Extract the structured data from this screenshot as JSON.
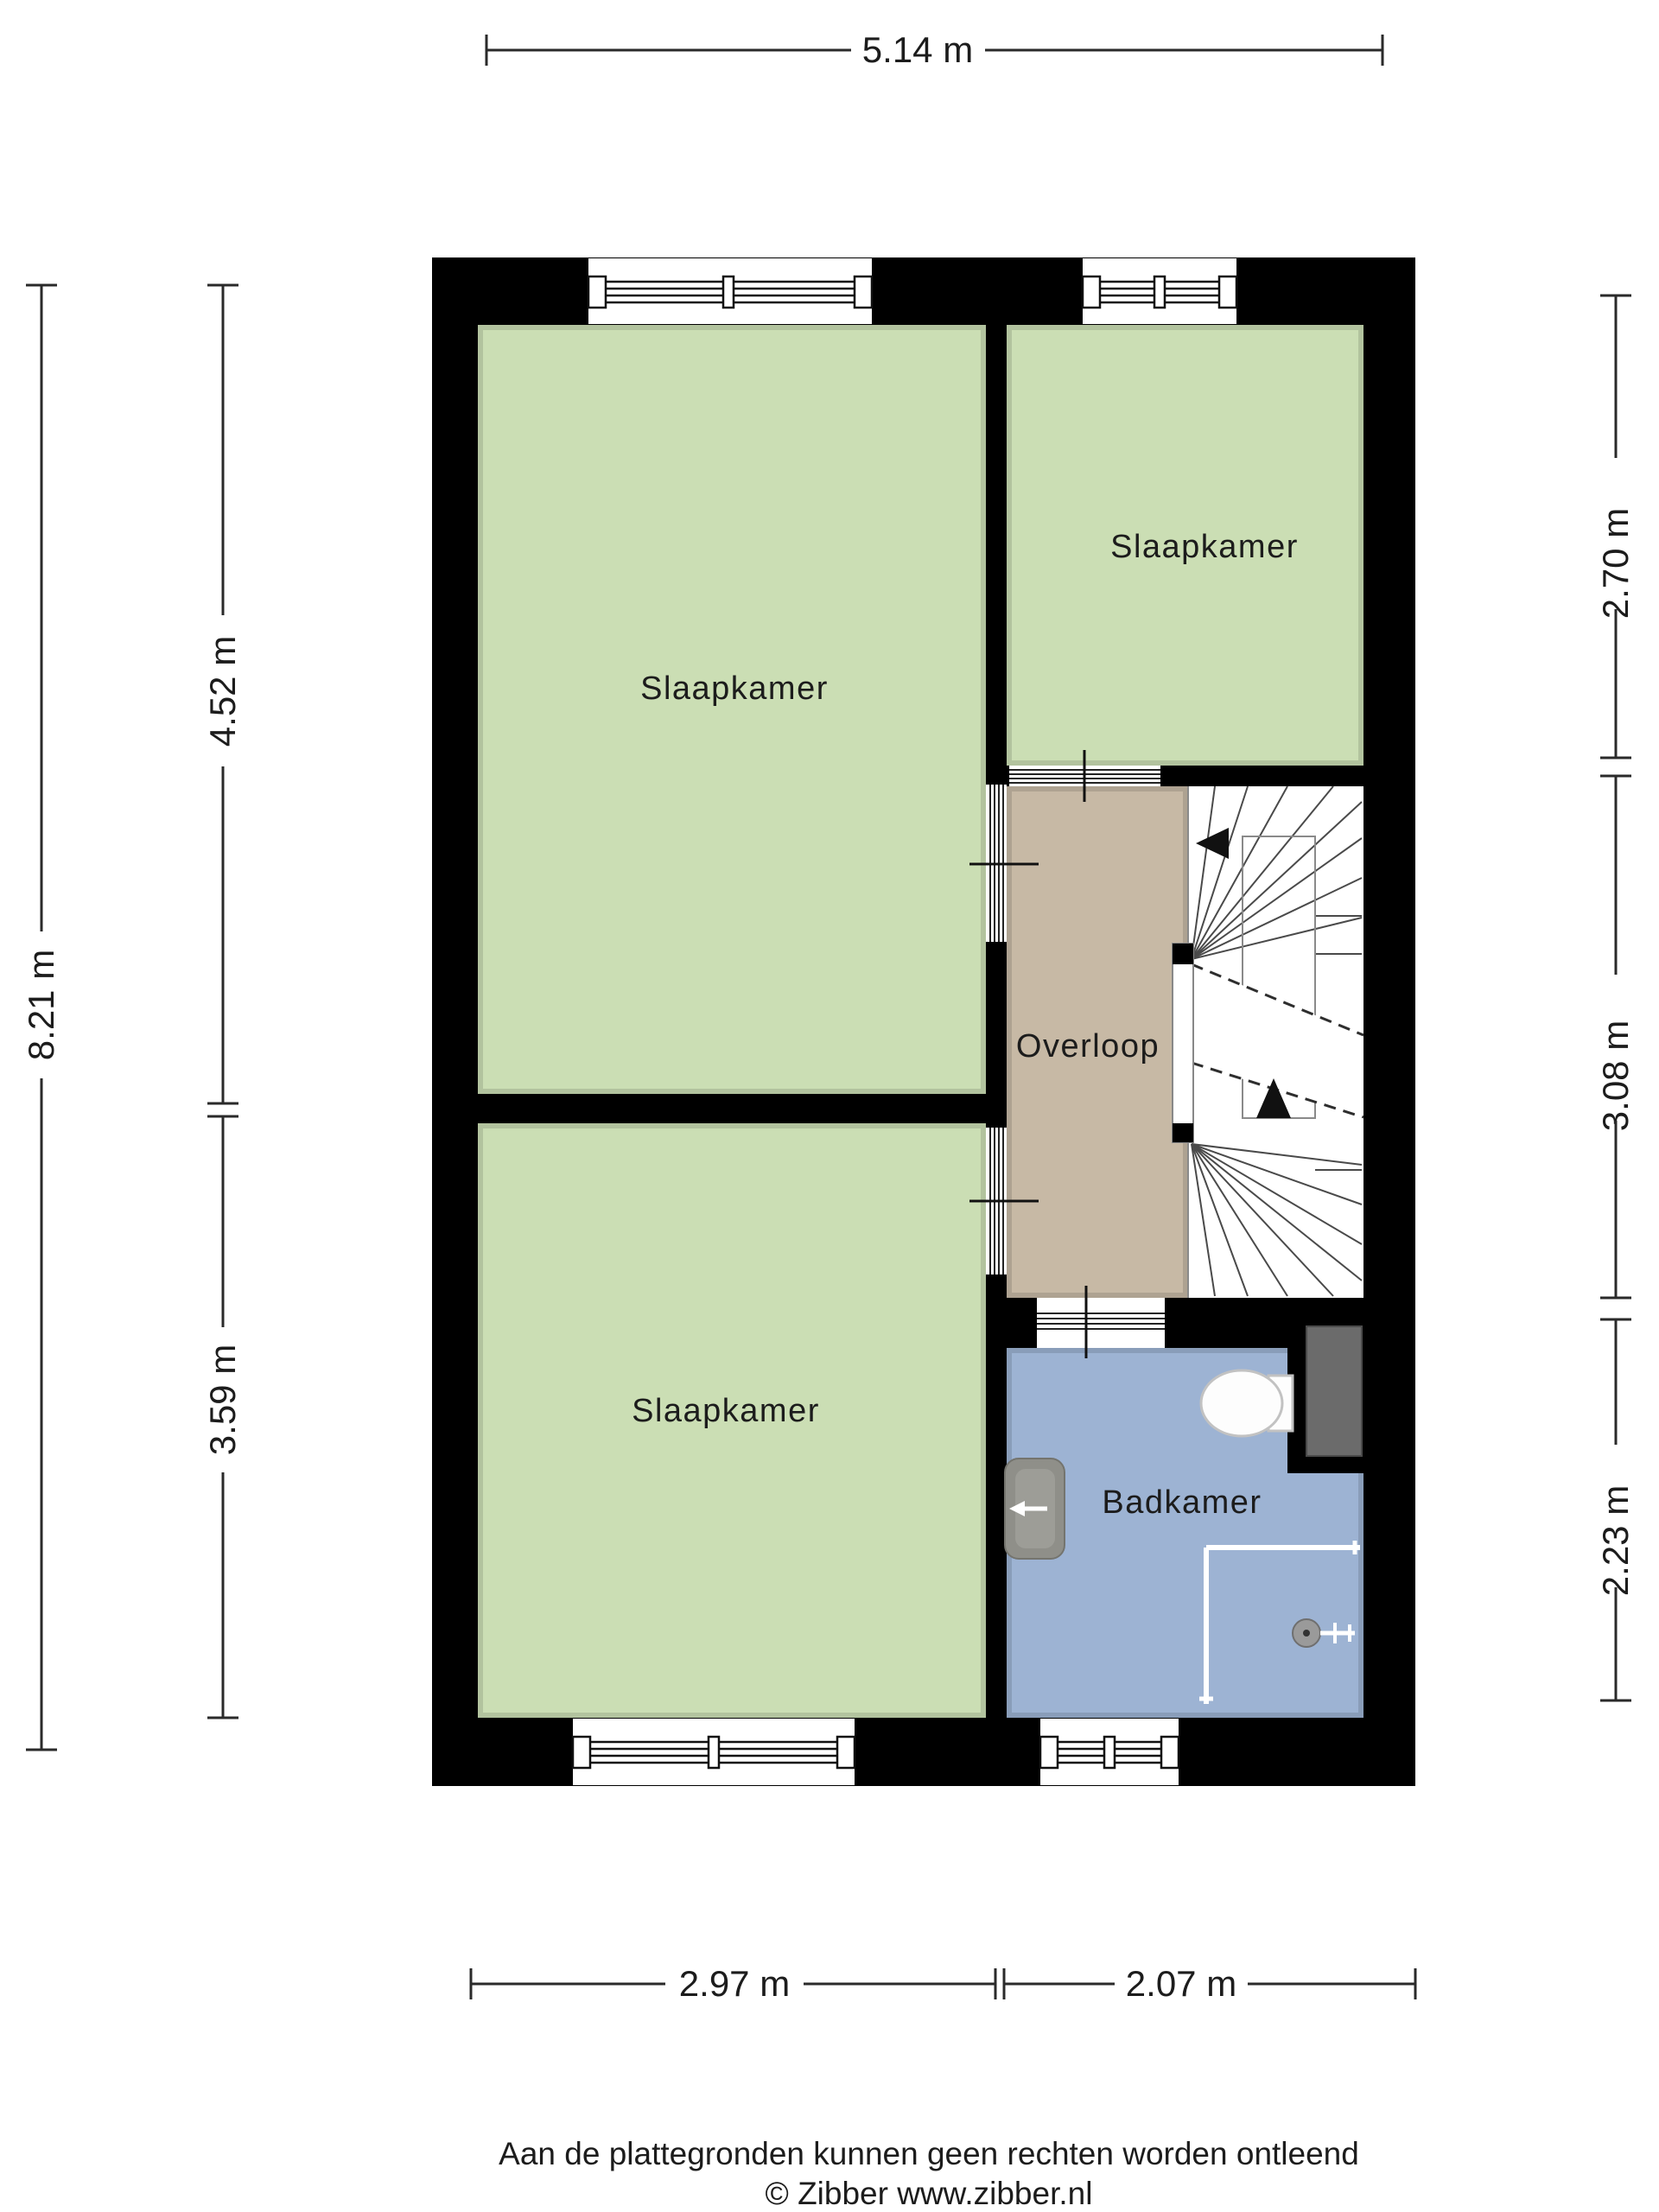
{
  "colors": {
    "wall": "#000000",
    "bedroom_fill": "#cbdeb4",
    "hallway_fill": "#c7b9a5",
    "bathroom_fill": "#9db3d3",
    "duct_fill": "#6b6b6b",
    "dimension_line": "#2a2a2a"
  },
  "rooms": {
    "bedroom_upper_left": {
      "label": "Slaapkamer"
    },
    "bedroom_top_right": {
      "label": "Slaapkamer"
    },
    "bedroom_lower_left": {
      "label": "Slaapkamer"
    },
    "hallway": {
      "label": "Overloop"
    },
    "bathroom": {
      "label": "Badkamer"
    }
  },
  "dimensions": {
    "top_width": {
      "label": "5.14 m"
    },
    "left_total_height": {
      "label": "8.21 m"
    },
    "left_upper": {
      "label": "4.52 m"
    },
    "left_lower": {
      "label": "3.59 m"
    },
    "right_top": {
      "label": "2.70 m"
    },
    "right_middle": {
      "label": "3.08 m"
    },
    "right_bottom": {
      "label": "2.23 m"
    },
    "bottom_left": {
      "label": "2.97 m"
    },
    "bottom_right": {
      "label": "2.07 m"
    }
  },
  "footer": {
    "disclaimer": "Aan de plattegronden kunnen geen rechten worden ontleend",
    "copyright": "© Zibber www.zibber.nl"
  }
}
